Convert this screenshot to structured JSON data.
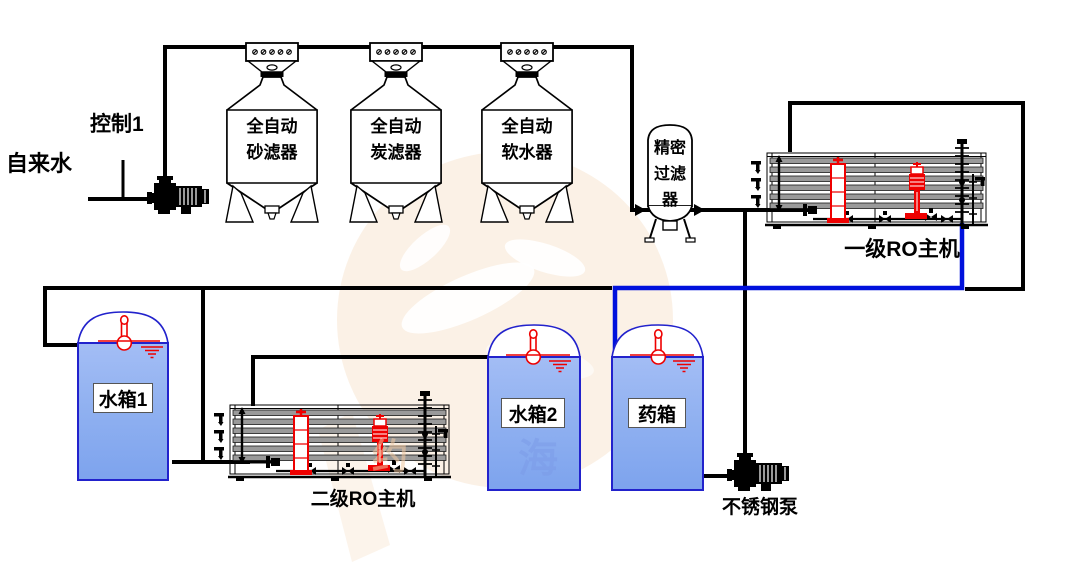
{
  "labels": {
    "control_1": "控制1",
    "raw_water": "自来水",
    "sand_filter": "全自动\n砂滤器",
    "carbon_filter": "全自动\n炭滤器",
    "softener": "全自动\n软水器",
    "precision_filter": "精密\n过滤\n器",
    "ro_stage1": "一级RO主机",
    "ro_stage2": "二级RO主机",
    "water_tank_1": "水箱1",
    "water_tank_2": "水箱2",
    "chemical_tank": "药箱",
    "stainless_pump": "不锈钢泵",
    "watermark_char_1": "约",
    "watermark_char_2": "海"
  },
  "colors": {
    "pipe_line": "#000000",
    "permeate_line": "#0011dd",
    "equipment_highlight_red": "#ee0000",
    "tank_fill": "#8fb0f0",
    "tank_outline": "#2222cc",
    "membrane_gray": "#9a9a9a",
    "watermark_peach": "#f8e3cd",
    "watermark_blue": "#7c9be8"
  }
}
